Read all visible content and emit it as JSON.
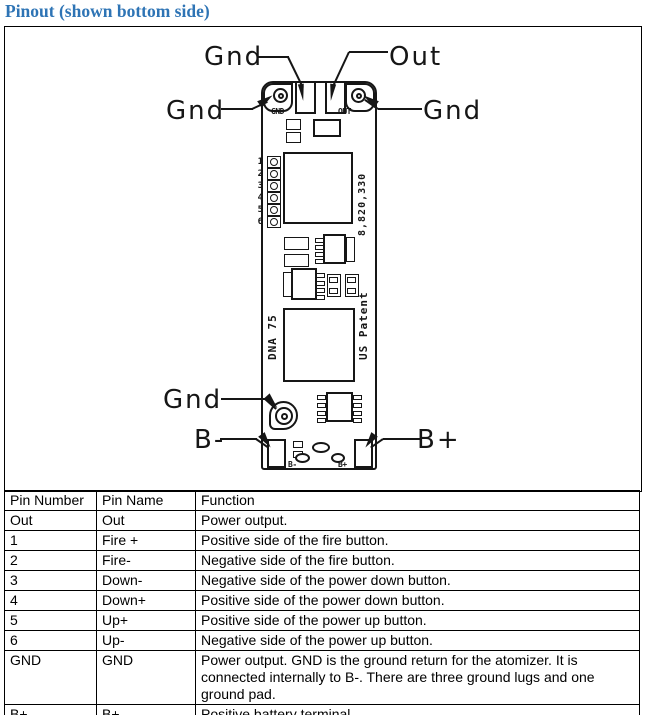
{
  "title": "Pinout (shown bottom side)",
  "colors": {
    "title_blue": "#2E74B5",
    "line_black": "#161616"
  },
  "diagram": {
    "labels": {
      "gnd_top": "Gnd",
      "out_top": "Out",
      "gnd_left": "Gnd",
      "gnd_right": "Gnd",
      "gnd_bottom": "Gnd",
      "b_minus": "B-",
      "b_plus": "B+"
    },
    "board": {
      "pad_gnd": "GND",
      "pad_out": "OUT",
      "pin_numbers": [
        "1",
        "2",
        "3",
        "4",
        "5",
        "6"
      ],
      "patent_number": "8,820,330",
      "chip_name": "DNA 75",
      "us_patent": "US Patent",
      "pad_b_minus": "B-",
      "pad_b_plus": "B+"
    }
  },
  "table": {
    "headers": [
      "Pin Number",
      "Pin Name",
      "Function"
    ],
    "rows": [
      {
        "pin_number": "Out",
        "pin_name": "Out",
        "function": "Power output."
      },
      {
        "pin_number": "1",
        "pin_name": "Fire +",
        "function": "Positive side of the fire button."
      },
      {
        "pin_number": "2",
        "pin_name": "Fire-",
        "function": "Negative side of the fire button."
      },
      {
        "pin_number": "3",
        "pin_name": "Down-",
        "function": "Negative side of the power down button."
      },
      {
        "pin_number": "4",
        "pin_name": "Down+",
        "function": "Positive side of the power down button."
      },
      {
        "pin_number": "5",
        "pin_name": "Up+",
        "function": "Positive side of the power up button."
      },
      {
        "pin_number": "6",
        "pin_name": "Up-",
        "function": "Negative side of the power up button."
      },
      {
        "pin_number": "GND",
        "pin_name": "GND",
        "function": "Power output. GND is the ground return for the atomizer. It is connected internally to B-. There are three ground lugs and one ground pad."
      },
      {
        "pin_number": "B+",
        "pin_name": "B+",
        "function": "Positive battery terminal."
      },
      {
        "pin_number": "B-",
        "pin_name": "B-",
        "function": "Negative battery terminal. Internally connected to Gnd"
      }
    ]
  }
}
